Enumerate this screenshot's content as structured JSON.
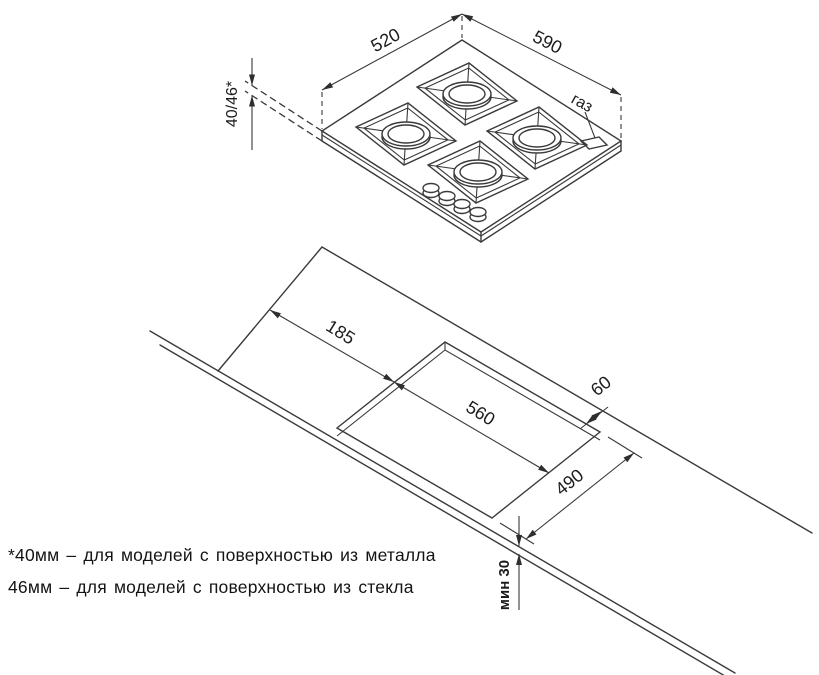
{
  "drawing": {
    "top_view": {
      "width": "520",
      "depth": "590",
      "height": "40/46*",
      "gas": "газ"
    },
    "installation_view": {
      "edge_offset": "185",
      "cutout_length": "560",
      "back_gap": "60",
      "cutout_width": "490",
      "front_min": "мин 30"
    },
    "footnotes": [
      "*40мм – для моделей с поверхностью из металла",
      "46мм – для моделей с поверхностью из стекла"
    ]
  },
  "colors": {
    "line": "#3a3a3a",
    "text": "#1c1c1c",
    "background": "#ffffff"
  }
}
